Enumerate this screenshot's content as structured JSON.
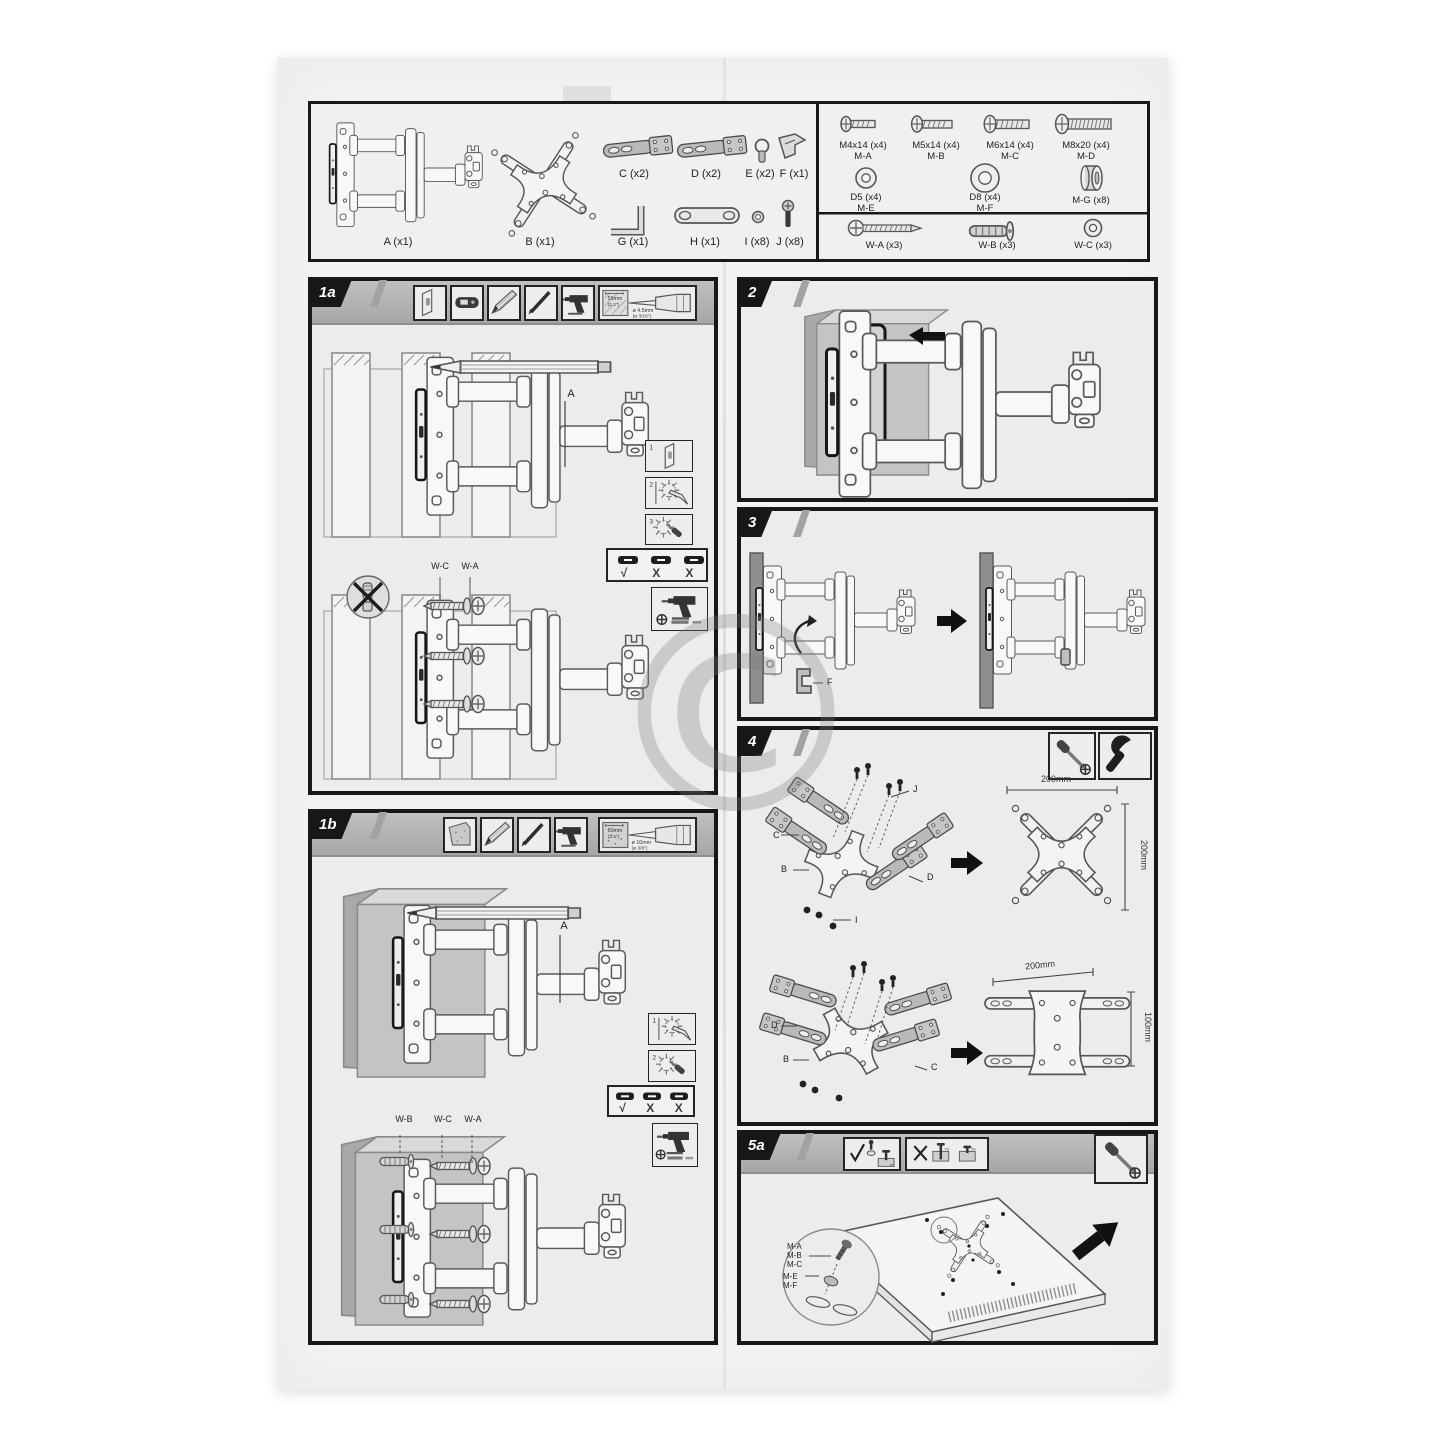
{
  "ghost": {
    "title": "TV WALL MOUNT",
    "subtitle": "TO TV LCD/LED",
    "copyright": "©"
  },
  "kit": {
    "parts": [
      {
        "label": "A (x1)"
      },
      {
        "label": "B (x1)"
      },
      {
        "label": "C (x2)"
      },
      {
        "label": "D (x2)"
      },
      {
        "label": "E (x2)"
      },
      {
        "label": "F (x1)"
      },
      {
        "label": "G (x1)"
      },
      {
        "label": "H (x1)"
      },
      {
        "label": "I (x8)"
      },
      {
        "label": "J (x8)"
      }
    ],
    "screws": [
      {
        "size": "M4x14 (x4)",
        "code": "M-A"
      },
      {
        "size": "M5x14 (x4)",
        "code": "M-B"
      },
      {
        "size": "M6x14 (x4)",
        "code": "M-C"
      },
      {
        "size": "M8x20 (x4)",
        "code": "M-D"
      }
    ],
    "washers": [
      {
        "size": "D5 (x4)",
        "code": "M-E"
      },
      {
        "size": "D8 (x4)",
        "code": "M-F"
      },
      {
        "size": "M-G (x8)",
        "code": ""
      }
    ],
    "wall": [
      {
        "label": "W-A (x3)"
      },
      {
        "label": "W-B (x3)"
      },
      {
        "label": "W-C (x3)"
      }
    ]
  },
  "common": {
    "check": "√",
    "cross": "X",
    "tv": "TV"
  },
  "s1a": {
    "tab": "1a",
    "point_a": "A",
    "wc": "W-C",
    "wa": "W-A",
    "insets": [
      "1",
      "2",
      "3"
    ],
    "drill": {
      "d1": "55mm",
      "d2": "(2.2\")",
      "d3": "ø 4.5mm",
      "d4": "(ø 3/16\")"
    }
  },
  "s1b": {
    "tab": "1b",
    "point_a": "A",
    "wb": "W-B",
    "wc": "W-C",
    "wa": "W-A",
    "insets": [
      "1",
      "2"
    ],
    "drill": {
      "d1": "60mm",
      "d2": "(2.4\")",
      "d3": "ø 10mm",
      "d4": "(ø 3/8\")"
    }
  },
  "s2": {
    "tab": "2"
  },
  "s3": {
    "tab": "3",
    "f": "F"
  },
  "s4": {
    "tab": "4",
    "upper": {
      "c": "C",
      "b": "B",
      "d": "D",
      "j": "J",
      "i": "I",
      "w": "200mm",
      "h": "200mm"
    },
    "lower": {
      "d": "D",
      "b": "B",
      "c": "C",
      "w": "200mm",
      "h": "100mm"
    }
  },
  "s5a": {
    "tab": "5a",
    "screws": [
      "M-A",
      "M-B",
      "M-C"
    ],
    "washers": [
      "M-E",
      "M-F"
    ]
  }
}
